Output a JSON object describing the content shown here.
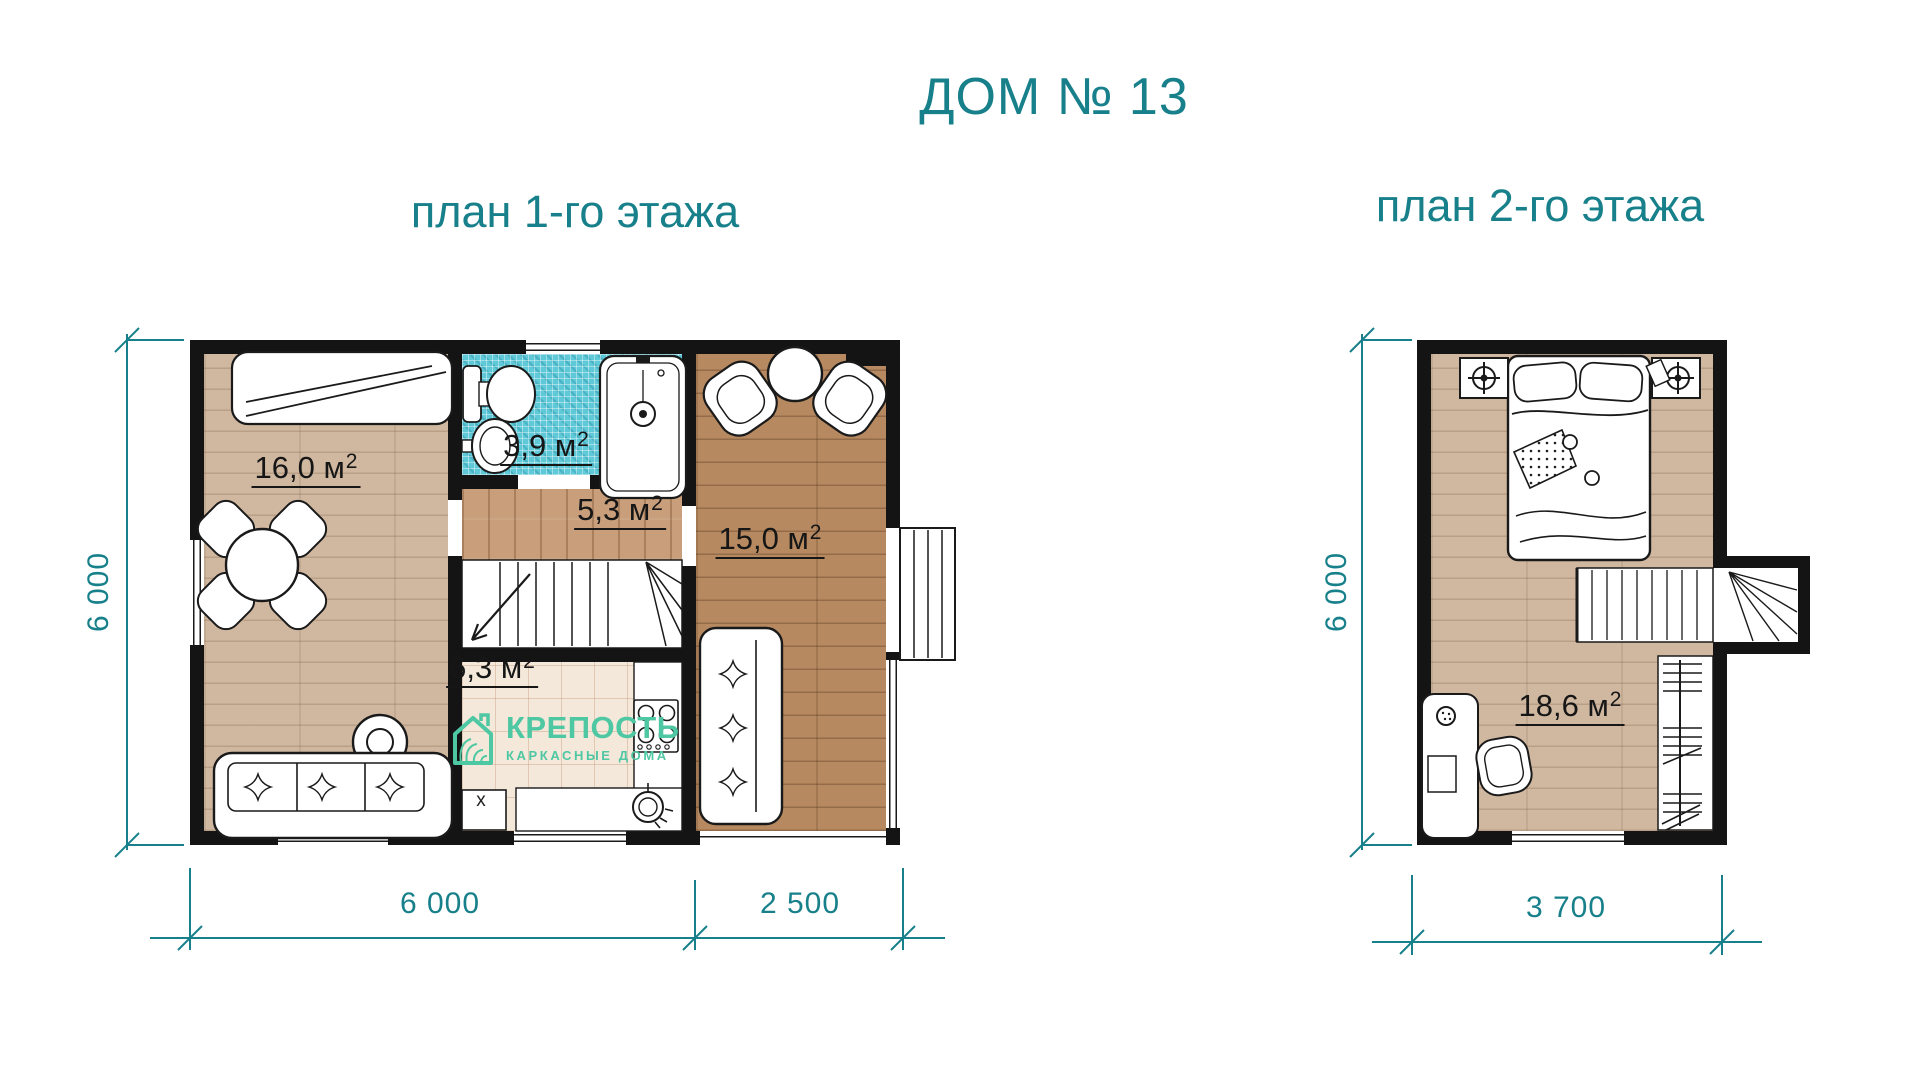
{
  "titles": {
    "main": "ДОМ № 13",
    "plan1": "план 1-го этажа",
    "plan2": "план 2-го этажа"
  },
  "colors": {
    "accent_teal": "#17808a",
    "logo_mint": "#4ec7a3",
    "wall_black": "#141414",
    "bath_tile_blue": "#5fc9d8",
    "wood_light": "#cfb7a0",
    "wood_medium": "#c89e7b",
    "wood_dark": "#b68960",
    "kitchen_tile_cream": "#f4e8da"
  },
  "first_floor": {
    "rooms": [
      {
        "id": "living-room",
        "area": "16,0 м",
        "exp": "2"
      },
      {
        "id": "bathroom",
        "area": "3,9 м",
        "exp": "2"
      },
      {
        "id": "hall",
        "area": "5,3 м",
        "exp": "2"
      },
      {
        "id": "lounge",
        "area": "15,0 м",
        "exp": "2"
      },
      {
        "id": "kitchen",
        "area": "6,3 м",
        "exp": "2"
      }
    ],
    "washer_label": "x",
    "dimensions": {
      "bottom": [
        "6 000",
        "2 500"
      ],
      "left": "6 000"
    }
  },
  "second_floor": {
    "rooms": [
      {
        "id": "bedroom",
        "area": "18,6 м",
        "exp": "2"
      }
    ],
    "dimensions": {
      "bottom": [
        "3 700"
      ],
      "left": "6 000"
    }
  },
  "logo": {
    "name": "КРЕПОСТЬ",
    "tagline": "КАРКАСНЫЕ ДОМА"
  }
}
